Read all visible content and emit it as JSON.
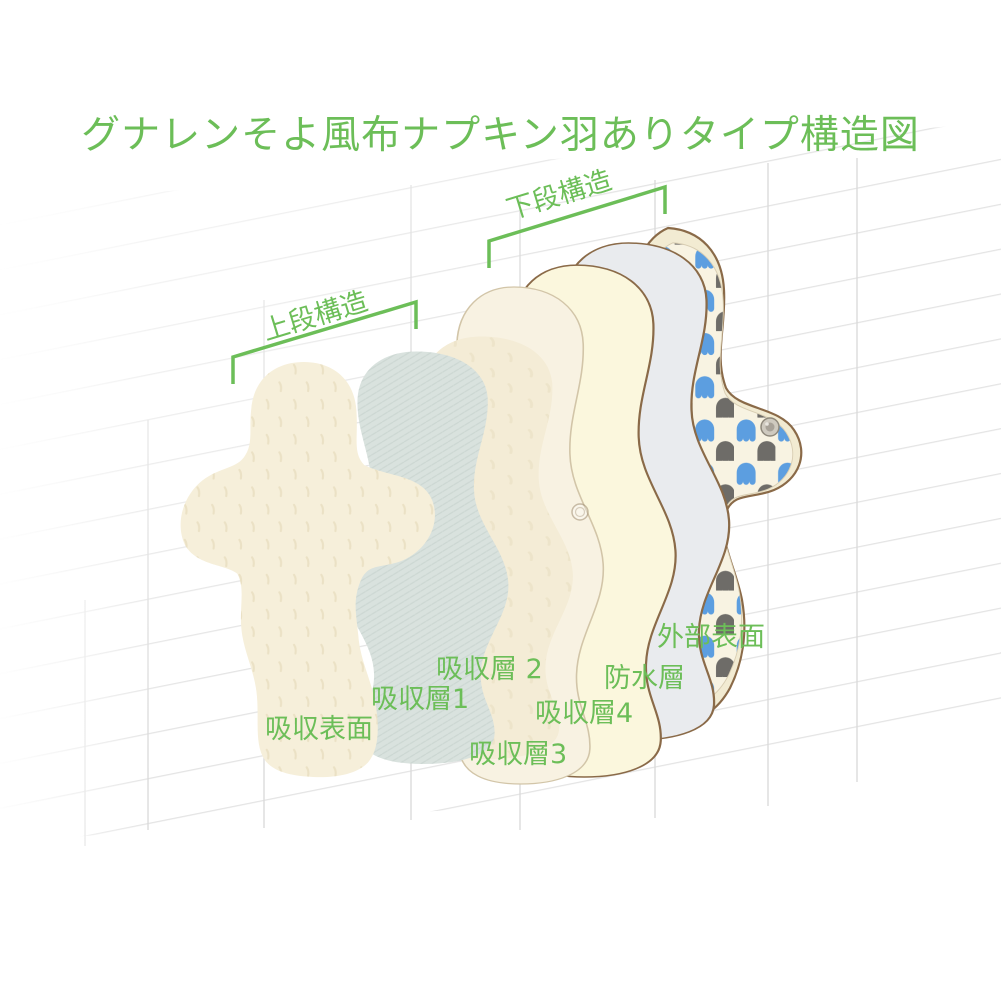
{
  "title": "グナレンそよ風布ナプキン羽ありタイプ構造図",
  "brackets": {
    "upper": "上段構造",
    "lower": "下段構造"
  },
  "layers": [
    {
      "label": "吸収表面",
      "color": "#F6EFDA"
    },
    {
      "label": "吸収層1",
      "color": "#D9E2DE"
    },
    {
      "label": "吸収層 2",
      "color": "#F4ECD6"
    },
    {
      "label": "吸収層3",
      "color": "#F8F2E2"
    },
    {
      "label": "吸収層4",
      "color": "#FBF7DD"
    },
    {
      "label": "防水層",
      "color": "#E9EBEE"
    },
    {
      "label": "外部表面",
      "color": "#F2EBD2",
      "pattern_blue": "#5C9EE0",
      "pattern_gray": "#6E6C68"
    }
  ],
  "colors": {
    "accent_green": "#6CBE58",
    "outline_brown": "#8A6A48"
  }
}
